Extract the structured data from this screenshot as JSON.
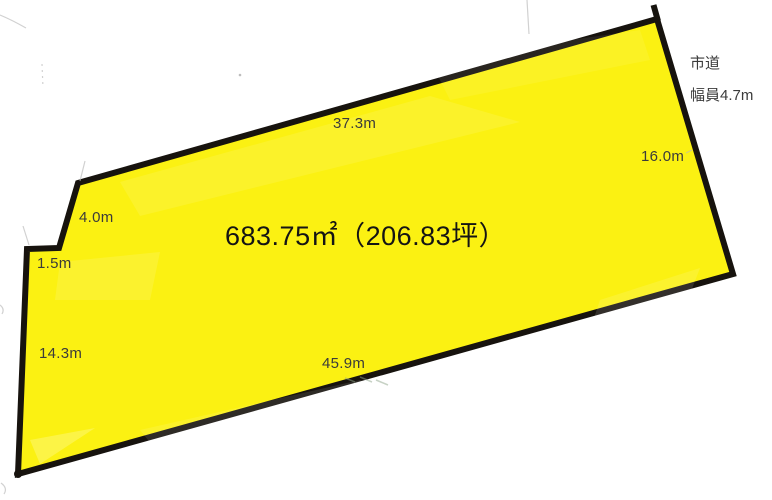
{
  "diagram": {
    "title": "land-parcel-survey-diagram",
    "area_label": "683.75㎡（206.83坪）",
    "edge_labels": {
      "top": "37.3m",
      "right": "16.0m",
      "upper_left": "4.0m",
      "left_jog": "1.5m",
      "left": "14.3m",
      "bottom": "45.9m"
    },
    "road": {
      "name": "市道",
      "width": "幅員4.7m"
    }
  },
  "colors": {
    "background": "#ffffff",
    "parcel_fill": "#fbf112",
    "parcel_border": "#17130e",
    "dimension_text": "#3b3b3b",
    "area_text": "#141414",
    "artifact_gray": "#b9b9b9"
  }
}
